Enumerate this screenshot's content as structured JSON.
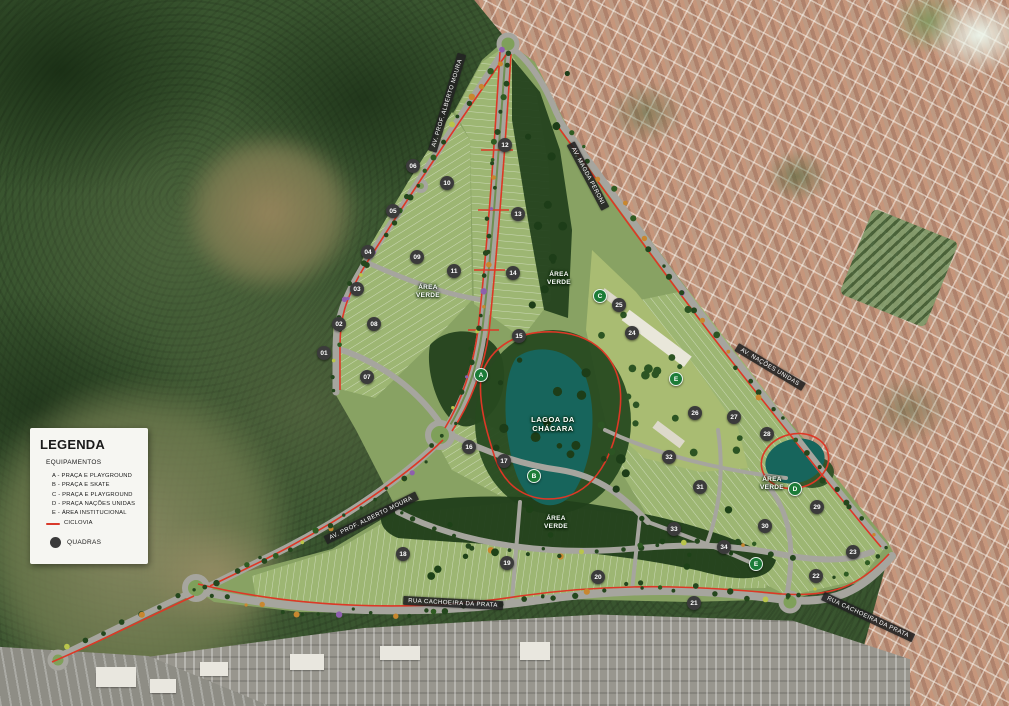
{
  "legend": {
    "title": "LEGENDA",
    "subtitle": "EQUIPAMENTOS",
    "items": [
      "A - PRAÇA E PLAYGROUND",
      "B - PRAÇA E SKATE",
      "C - PRAÇA E PLAYGROUND",
      "D - PRAÇA NAÇÕES UNIDAS",
      "E - ÁREA INSTITUCIONAL"
    ],
    "ciclovia_label": "CICLOVIA",
    "quadras_label": "QUADRAS"
  },
  "colors": {
    "ciclovia": "#dd3826",
    "lagoon": "#17655c",
    "equipment_marker": "#1c7c38",
    "quadra_badge": "#3b3b3b",
    "plan_green": "#88a263"
  },
  "street_labels": [
    {
      "text": "AV. PROF. ALBERTO MOURA",
      "x": 447,
      "y": 103,
      "rot": -73
    },
    {
      "text": "AV. MAGDA PERONI",
      "x": 588,
      "y": 176,
      "rot": 62
    },
    {
      "text": "AV. NAÇÕES UNIDAS",
      "x": 770,
      "y": 367,
      "rot": 31
    },
    {
      "text": "AV. PROF. ALBERTO MOURA",
      "x": 371,
      "y": 518,
      "rot": -26
    },
    {
      "text": "RUA CACHOEIRA DA PRATA",
      "x": 453,
      "y": 603,
      "rot": 3
    },
    {
      "text": "RUA CACHOEIRA DA PRATA",
      "x": 868,
      "y": 617,
      "rot": 25
    }
  ],
  "area_labels": [
    {
      "text": "ÁREA\nVERDE",
      "x": 428,
      "y": 292
    },
    {
      "text": "ÁREA\nVERDE",
      "x": 559,
      "y": 279
    },
    {
      "text": "LAGOA DA\nCHÁCARA",
      "x": 553,
      "y": 424,
      "large": true
    },
    {
      "text": "ÁREA\nVERDE",
      "x": 772,
      "y": 484
    },
    {
      "text": "ÁREA\nVERDE",
      "x": 556,
      "y": 523
    }
  ],
  "equipment_markers": [
    {
      "letter": "A",
      "x": 481,
      "y": 375
    },
    {
      "letter": "B",
      "x": 534,
      "y": 476
    },
    {
      "letter": "C",
      "x": 600,
      "y": 296
    },
    {
      "letter": "D",
      "x": 795,
      "y": 489
    },
    {
      "letter": "E",
      "x": 676,
      "y": 379
    },
    {
      "letter": "E",
      "x": 756,
      "y": 564
    }
  ],
  "quadras": [
    {
      "n": "01",
      "x": 324,
      "y": 353
    },
    {
      "n": "02",
      "x": 339,
      "y": 324
    },
    {
      "n": "03",
      "x": 357,
      "y": 289
    },
    {
      "n": "04",
      "x": 368,
      "y": 252
    },
    {
      "n": "05",
      "x": 393,
      "y": 211
    },
    {
      "n": "06",
      "x": 413,
      "y": 166
    },
    {
      "n": "07",
      "x": 367,
      "y": 377
    },
    {
      "n": "08",
      "x": 374,
      "y": 324
    },
    {
      "n": "09",
      "x": 417,
      "y": 257
    },
    {
      "n": "10",
      "x": 447,
      "y": 183
    },
    {
      "n": "11",
      "x": 454,
      "y": 271
    },
    {
      "n": "12",
      "x": 505,
      "y": 145
    },
    {
      "n": "13",
      "x": 518,
      "y": 214
    },
    {
      "n": "14",
      "x": 513,
      "y": 273
    },
    {
      "n": "15",
      "x": 519,
      "y": 336
    },
    {
      "n": "16",
      "x": 469,
      "y": 447
    },
    {
      "n": "17",
      "x": 504,
      "y": 461
    },
    {
      "n": "18",
      "x": 403,
      "y": 554
    },
    {
      "n": "19",
      "x": 507,
      "y": 563
    },
    {
      "n": "20",
      "x": 598,
      "y": 577
    },
    {
      "n": "21",
      "x": 694,
      "y": 603
    },
    {
      "n": "22",
      "x": 816,
      "y": 576
    },
    {
      "n": "23",
      "x": 853,
      "y": 552
    },
    {
      "n": "24",
      "x": 632,
      "y": 333
    },
    {
      "n": "25",
      "x": 619,
      "y": 305
    },
    {
      "n": "26",
      "x": 695,
      "y": 413
    },
    {
      "n": "27",
      "x": 734,
      "y": 417
    },
    {
      "n": "28",
      "x": 767,
      "y": 434
    },
    {
      "n": "29",
      "x": 817,
      "y": 507
    },
    {
      "n": "30",
      "x": 765,
      "y": 526
    },
    {
      "n": "31",
      "x": 700,
      "y": 487
    },
    {
      "n": "32",
      "x": 669,
      "y": 457
    },
    {
      "n": "33",
      "x": 674,
      "y": 529
    },
    {
      "n": "34",
      "x": 724,
      "y": 547
    }
  ]
}
